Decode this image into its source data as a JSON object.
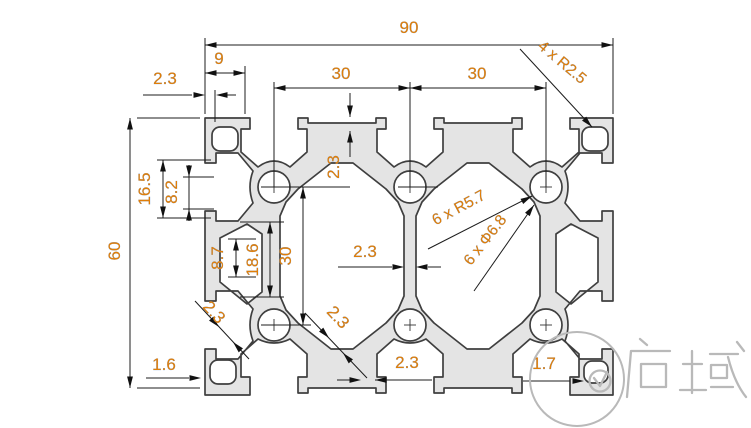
{
  "drawing": {
    "type": "aluminium-extrusion-profile-cross-section",
    "colors": {
      "profile_fill": "#e4e4e4",
      "profile_outline": "#3f3f3f",
      "dimension_line": "#1c1c1c",
      "dimension_text": "#e07e08",
      "watermark": "#b9b9b9"
    },
    "dimensions": [
      {
        "id": "overall-width",
        "label": "90"
      },
      {
        "id": "corner-tab-width",
        "label": "9"
      },
      {
        "id": "wall-thickness-top-left",
        "label": "2.3"
      },
      {
        "id": "slot-pitch-left",
        "label": "30"
      },
      {
        "id": "slot-pitch-right",
        "label": "30"
      },
      {
        "id": "corner-radius",
        "label": "4 x R2.5"
      },
      {
        "id": "overall-height",
        "label": "60"
      },
      {
        "id": "side-slot-outer-width",
        "label": "16.5"
      },
      {
        "id": "side-slot-mouth-width",
        "label": "8.2"
      },
      {
        "id": "top-flange-thickness",
        "label": "2.3"
      },
      {
        "id": "side-groove-width",
        "label": "8.7"
      },
      {
        "id": "side-cavity-width",
        "label": "18.6"
      },
      {
        "id": "hole-pitch-vertical",
        "label": "30"
      },
      {
        "id": "center-web-thickness",
        "label": "2.3"
      },
      {
        "id": "boss-radius",
        "label": "6 x R5.7"
      },
      {
        "id": "core-hole-diameter",
        "label": "6 x Φ6.8"
      },
      {
        "id": "diagonal-wall-lower-left",
        "label": "2.3"
      },
      {
        "id": "diagonal-wall-lower-middle",
        "label": "2.3"
      },
      {
        "id": "bottom-web-thickness",
        "label": "2.3"
      },
      {
        "id": "bottom-wall-left",
        "label": "1.6"
      },
      {
        "id": "bottom-wall-right",
        "label": "1.7"
      }
    ],
    "watermark": {
      "text": "启域"
    }
  }
}
